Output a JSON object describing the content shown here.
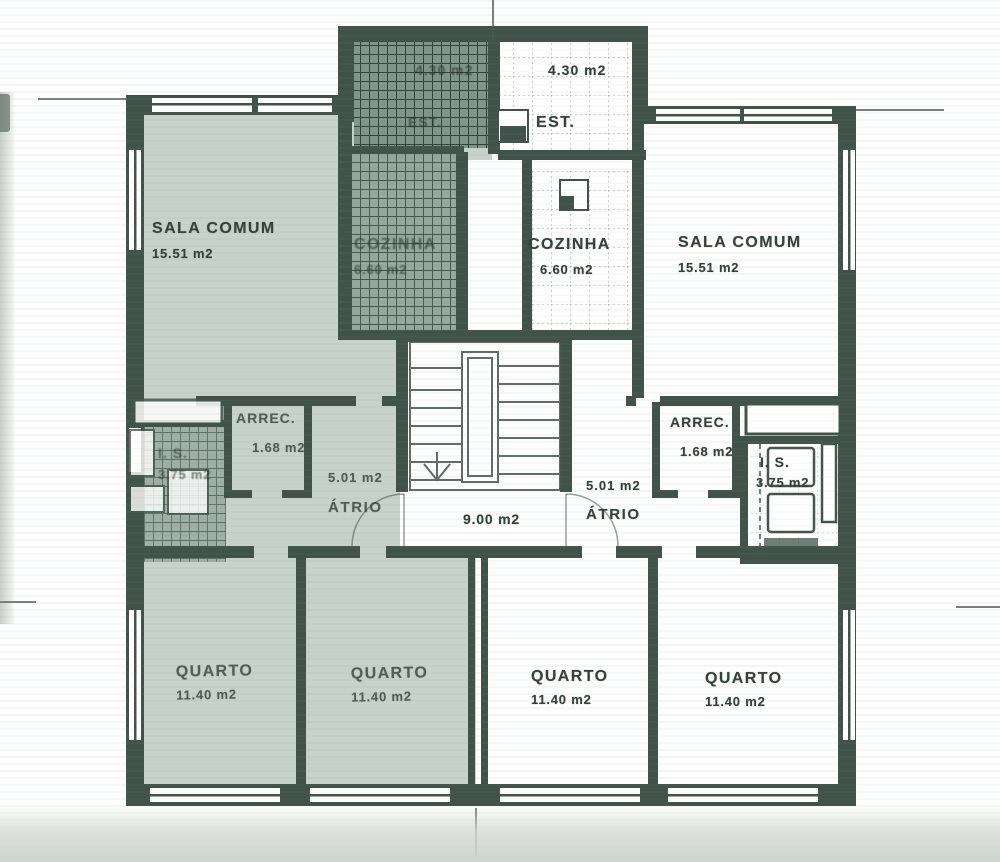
{
  "rooms": {
    "sala_left": {
      "name": "SALA COMUM",
      "area": "15.51 m2"
    },
    "sala_right": {
      "name": "SALA COMUM",
      "area": "15.51 m2"
    },
    "cozinha_left": {
      "name": "COZINHA",
      "area": "6.60 m2"
    },
    "cozinha_right": {
      "name": "COZINHA",
      "area": "6.60 m2"
    },
    "est_left": {
      "name": "EST.",
      "area": "4.30 m2"
    },
    "est_right": {
      "name": "EST.",
      "area": "4.30 m2"
    },
    "arrec_left": {
      "name": "ARREC.",
      "area": "1.68 m2"
    },
    "arrec_right": {
      "name": "ARREC.",
      "area": "1.68 m2"
    },
    "is_left": {
      "name": "I. S.",
      "area": "3.75 m2"
    },
    "is_right": {
      "name": "I. S.",
      "area": "3.75 m2"
    },
    "atrio_left": {
      "name": "ÁTRIO",
      "area": "5.01 m2"
    },
    "atrio_right": {
      "name": "ÁTRIO",
      "area": "5.01 m2"
    },
    "stair_landing": {
      "area": "9.00 m2"
    },
    "quarto_left_1": {
      "name": "QUARTO",
      "area": "11.40 m2"
    },
    "quarto_left_2": {
      "name": "QUARTO",
      "area": "11.40 m2"
    },
    "quarto_right_1": {
      "name": "QUARTO",
      "area": "11.40 m2"
    },
    "quarto_right_2": {
      "name": "QUARTO",
      "area": "11.40 m2"
    }
  },
  "colors": {
    "ink": "#41524a",
    "left_apartment_tint": "#b9c7bd",
    "paper": "#fcfdfc"
  }
}
